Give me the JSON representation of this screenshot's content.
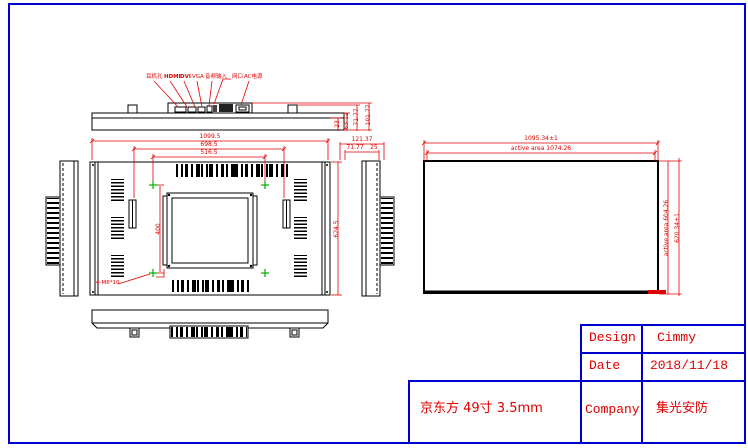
{
  "colors": {
    "line": "#000000",
    "dimension": "#e10000",
    "table": "#0000cd",
    "marker": "#00b000"
  },
  "top_view": {
    "connector_labels": [
      "耳机孔",
      "HDMI",
      "DVI",
      "VGA",
      "音频输入",
      "网口",
      "AC电源"
    ],
    "thickness_dims": [
      "23",
      "63.12",
      "71.77",
      "101.77"
    ]
  },
  "side_view": {
    "depth_dim_outer": "121.37",
    "depth_dim_inner": "71.77",
    "depth_dim_small": "25"
  },
  "front_view": {
    "overall_width": "1099.5",
    "bracket_spacing": "698.5",
    "vesa_width": "516.5",
    "vesa_height": "400",
    "overall_height": "624.5",
    "mount_hole_label": "4-M6*10"
  },
  "panel_view": {
    "overall_width": "1095.34±1",
    "active_width": "active area 1074.26",
    "active_height": "active area 604.26",
    "overall_height": "620.34±1"
  },
  "title_block": {
    "design_label": "Design",
    "design_value": "Cimmy",
    "date_label": "Date",
    "date_value": "2018/11/18",
    "company_label": "Company",
    "company_value": "集光安防",
    "spec": "京东方 49寸 3.5mm"
  }
}
